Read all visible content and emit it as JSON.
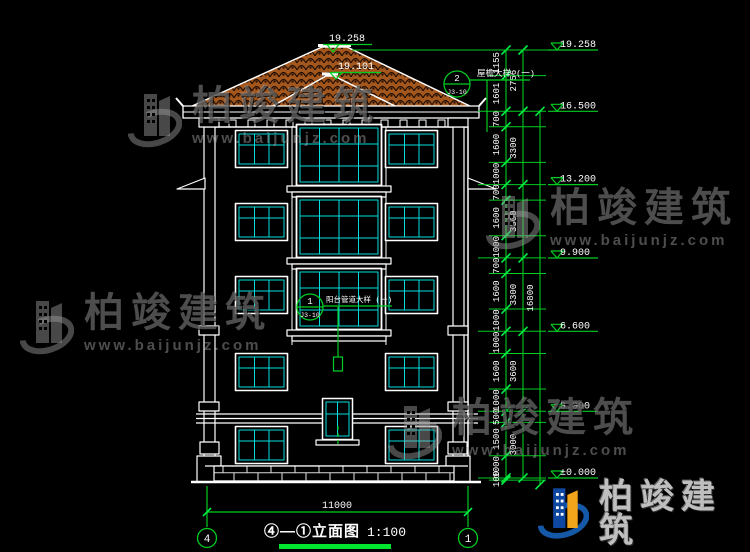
{
  "drawing": {
    "peak_level": "19.258",
    "ridge2_level": "19.101",
    "callout_eave": {
      "number": "2",
      "ref": "J3-10",
      "label": "屋檐大样 (一)"
    },
    "callout_balcony": {
      "number": "1",
      "ref": "J3-10",
      "label": "阳台管道大样 (一)"
    },
    "bottom_dim": "11000",
    "grid_bubble_left": "4",
    "grid_bubble_right": "1",
    "title": {
      "text": "④—①立面图",
      "scale": "1:100"
    }
  },
  "dimensions": {
    "chains": [
      {
        "x": 506,
        "top_mm": 19258,
        "segments": [
          1155,
          1601,
          700,
          1600,
          1000,
          700,
          1600,
          1000,
          700,
          1600,
          1000,
          1000,
          1600,
          1000,
          500,
          1500,
          1000,
          100
        ]
      },
      {
        "x": 523,
        "top_mm": 19258,
        "segments": [
          2756,
          3300,
          3300,
          3300,
          3600,
          3000
        ]
      },
      {
        "x": 540,
        "top_mm": 16500,
        "segments": [
          16800
        ]
      }
    ],
    "levels": [
      {
        "label": "19.258",
        "mm": 19258
      },
      {
        "label": "16.500",
        "mm": 16500
      },
      {
        "label": "13.200",
        "mm": 13200
      },
      {
        "label": "9.900",
        "mm": 9900
      },
      {
        "label": "6.600",
        "mm": 6600
      },
      {
        "label": "3.000",
        "mm": 3000
      },
      {
        "label": "±0.000",
        "mm": 0
      }
    ]
  },
  "watermark": {
    "brand": "柏竣建筑",
    "url": "www.baijunjz.com"
  },
  "colors": {
    "line": "#ffffff",
    "dim_green": "#00cc22",
    "bright_green": "#00e62e",
    "window_cyan": "#00dede",
    "roof_tile": "#a4571d",
    "logo_blue": "#0d47a1",
    "logo_orange": "#f2a41b"
  }
}
